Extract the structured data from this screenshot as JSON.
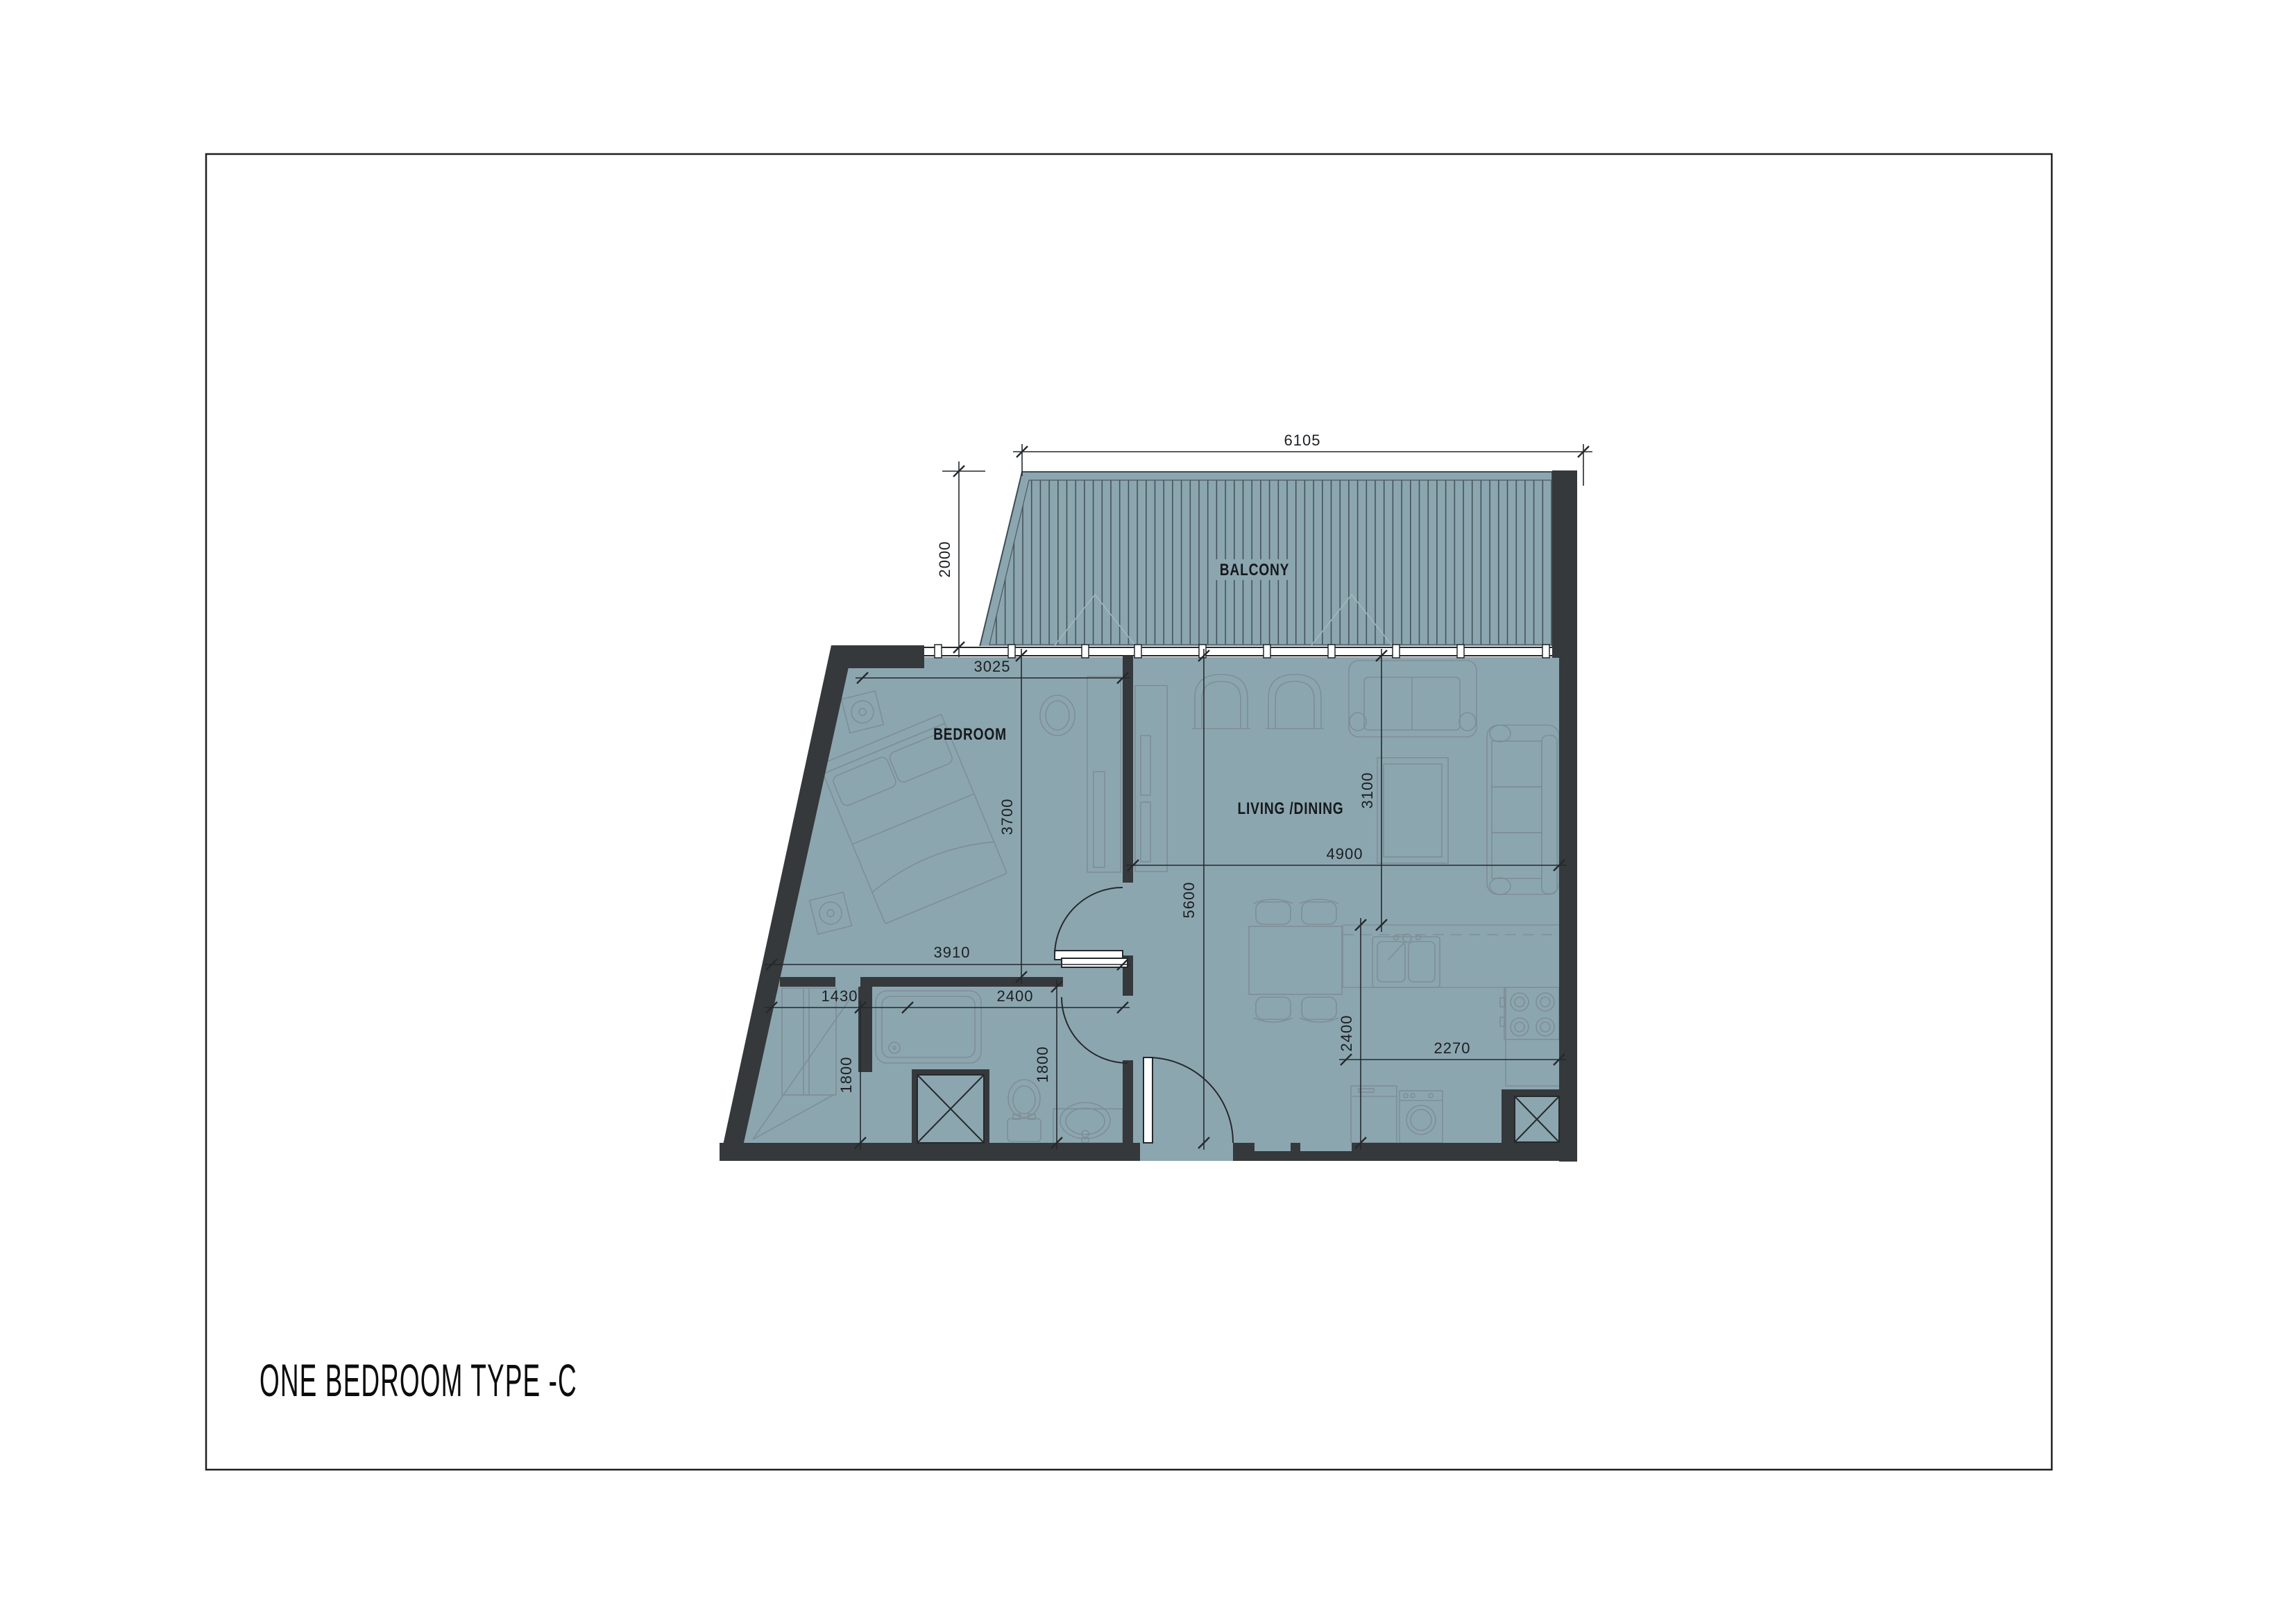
{
  "page": {
    "title": "ONE BEDROOM  TYPE -C"
  },
  "rooms": {
    "balcony": "BALCONY",
    "bedroom": "BEDROOM",
    "living": "LIVING /DINING"
  },
  "dims": {
    "balcony_width": "6105",
    "balcony_depth": "2000",
    "bedroom_width_top": "3025",
    "bedroom_depth": "3700",
    "bedroom_width_bottom": "3910",
    "hall_depth": "5600",
    "living_width": "4900",
    "living_depth": "3100",
    "closet_width": "1430",
    "bath_width": "2400",
    "closet_depth": "1800",
    "bath_depth": "1800",
    "kitchen_depth": "2400",
    "kitchen_width": "2270"
  },
  "colors": {
    "floor": "#8CA6B0",
    "wall": "#35393C",
    "hatch": "#44525A",
    "furniture": "#7E8E96",
    "faint": "#A4B7BF",
    "line": "#25292C",
    "dimtext": "#1B1F22",
    "label": "#15191C",
    "counter_dash": "#7D909A",
    "paper_border": "#1F1F1F"
  }
}
